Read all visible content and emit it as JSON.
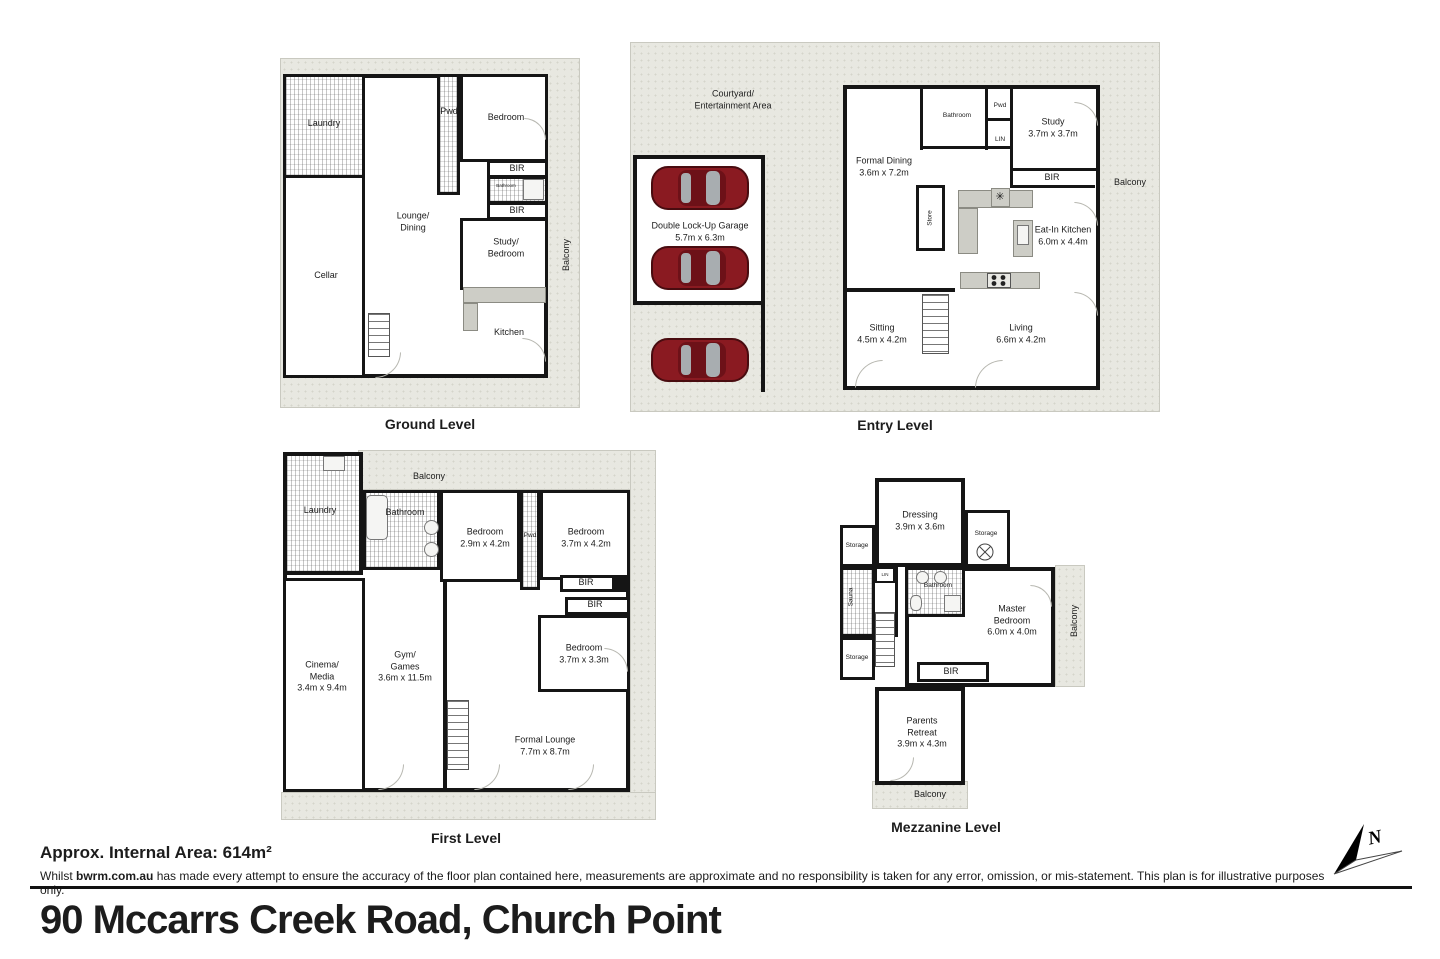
{
  "plans": {
    "ground": {
      "caption": "Ground Level",
      "labels": {
        "laundry": "Laundry",
        "cellar": "Cellar",
        "lounge_dining": "Lounge/\nDining",
        "pwd": "Pwd",
        "bedroom": "Bedroom",
        "bir_top": "BIR",
        "bathroom": "Bathroom",
        "bir_bottom": "BIR",
        "study_bedroom": "Study/\nBedroom",
        "kitchen": "Kitchen",
        "balcony": "Balcony"
      }
    },
    "entry": {
      "caption": "Entry Level",
      "labels": {
        "courtyard": "Courtyard/\nEntertainment Area",
        "garage": "Double Lock-Up Garage\n5.7m x 6.3m",
        "formal_dining": "Formal Dining\n3.6m x 7.2m",
        "bathroom": "Bathroom",
        "pwd": "Pwd",
        "lin": "LIN",
        "study": "Study\n3.7m x 3.7m",
        "bir": "BIR",
        "balcony": "Balcony",
        "store": "Store",
        "appliance": "✳",
        "eat_in_kitchen": "Eat-In Kitchen\n6.0m x 4.4m",
        "sitting": "Sitting\n4.5m x 4.2m",
        "living": "Living\n6.6m x 4.2m"
      }
    },
    "first": {
      "caption": "First Level",
      "labels": {
        "laundry": "Laundry",
        "balcony": "Balcony",
        "bathroom": "Bathroom",
        "bedroom1": "Bedroom\n2.9m x 4.2m",
        "pwd": "Pwd",
        "bedroom2": "Bedroom\n3.7m x 4.2m",
        "bir1": "BIR",
        "bir2": "BIR",
        "bedroom3": "Bedroom\n3.7m x 3.3m",
        "cinema": "Cinema/\nMedia\n3.4m x 9.4m",
        "gym": "Gym/\nGames\n3.6m x 11.5m",
        "formal_lounge": "Formal Lounge\n7.7m x 8.7m"
      }
    },
    "mezzanine": {
      "caption": "Mezzanine Level",
      "labels": {
        "dressing": "Dressing\n3.9m x 3.6m",
        "storage1": "Storage",
        "storage2": "Storage",
        "sauna": "Sauna",
        "lin": "LIN",
        "bathroom": "Bathroom",
        "master": "Master\nBedroom\n6.0m x 4.0m",
        "balcony_right": "Balcony",
        "storage3": "Storage",
        "bir": "BIR",
        "parents": "Parents\nRetreat\n3.9m x 4.3m",
        "balcony_bottom": "Balcony"
      }
    }
  },
  "footer": {
    "area": "Approx. Internal Area: 614m²",
    "disclaimer_prefix": "Whilst ",
    "disclaimer_brand": "bwrm.com.au",
    "disclaimer_rest": " has made every attempt to ensure the accuracy of the floor plan contained here, measurements are approximate and no responsibility is taken for any error, omission, or mis-statement. This plan is for illustrative purposes only."
  },
  "title": {
    "address": "90 Mccarrs Creek Road, Church Point"
  },
  "compass": {
    "label": "N"
  },
  "colors": {
    "wall": "#151515",
    "deck": "#e8e8e1",
    "car": "#8a1a21",
    "counter": "#cdcdc6"
  }
}
